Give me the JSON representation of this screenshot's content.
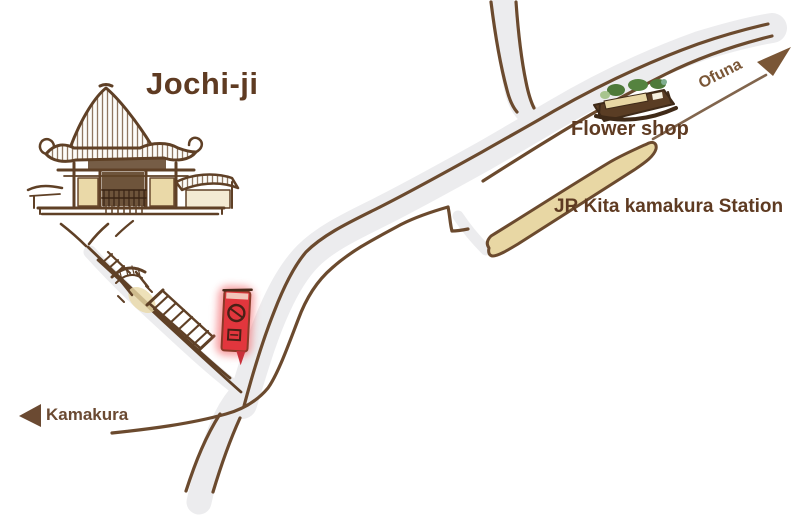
{
  "map": {
    "title": "Jochi-ji",
    "labels": {
      "flower_shop": "Flower shop",
      "station": "JR Kita kamakura Station",
      "direction_left": "Kamakura",
      "direction_right": "Ofuna"
    },
    "colors": {
      "ink_brown": "#6b4a2e",
      "text_brown": "#5f3b22",
      "road_fill": "#ececee",
      "platform_fill": "#e8d7a4",
      "temple_wall_fill": "#ead9a8",
      "banner_red": "#e2363d",
      "foliage_green": "#4e7a3a"
    },
    "icons": {
      "left_arrow": "kamakura-arrow-icon",
      "right_arrow": "ofuna-arrow-icon",
      "temple": "temple-illustration",
      "shop": "flower-shop-illustration",
      "platform": "station-platform",
      "banner": "red-banner-sign",
      "stairs": "stairs-icon",
      "gate": "gate-icon"
    }
  }
}
